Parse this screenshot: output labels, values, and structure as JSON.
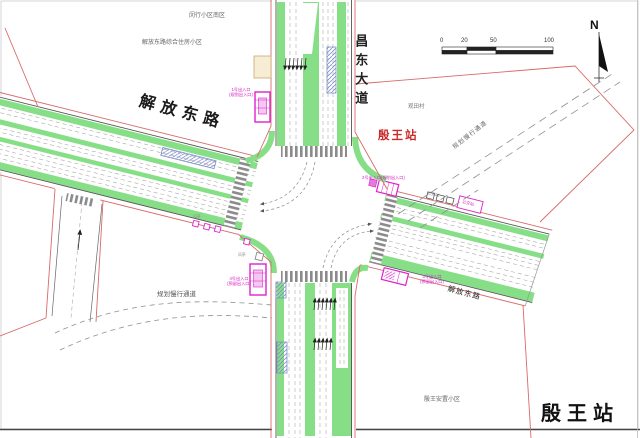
{
  "labels": {
    "district_north": "闵行小区南区",
    "residential_complex": "解放东路综合住房小区",
    "village": "观田村",
    "resettlement": "殷王安置小区",
    "slow_corridor": "规划慢行通道",
    "bus_stop": "公交站",
    "vent": "风亭"
  },
  "roads": {
    "west": "解放东路",
    "east": "解放东路",
    "north_south": "昌东大道"
  },
  "station": {
    "name_red": "殷王站",
    "name_big": "殷王站"
  },
  "entrances": [
    {
      "no": "1号出入口",
      "note": "(规划出入口)"
    },
    {
      "no": "2号出入口",
      "note": "(规划出入口)"
    },
    {
      "no": "3号出入口",
      "note": "(预留出入口)"
    },
    {
      "no": "4号出入口",
      "note": "(预留出入口)"
    }
  ],
  "map_tools": {
    "scale_ticks": [
      "0",
      "20",
      "50",
      "100"
    ],
    "north_label": "N"
  },
  "colors": {
    "green_verge": "#86df86",
    "red_planning_line": "#d96a6a",
    "magenta_entrance": "#dd22cc",
    "blue_platform_hatch": "#7f8fc7",
    "station_red_text": "#cc2a2a"
  }
}
